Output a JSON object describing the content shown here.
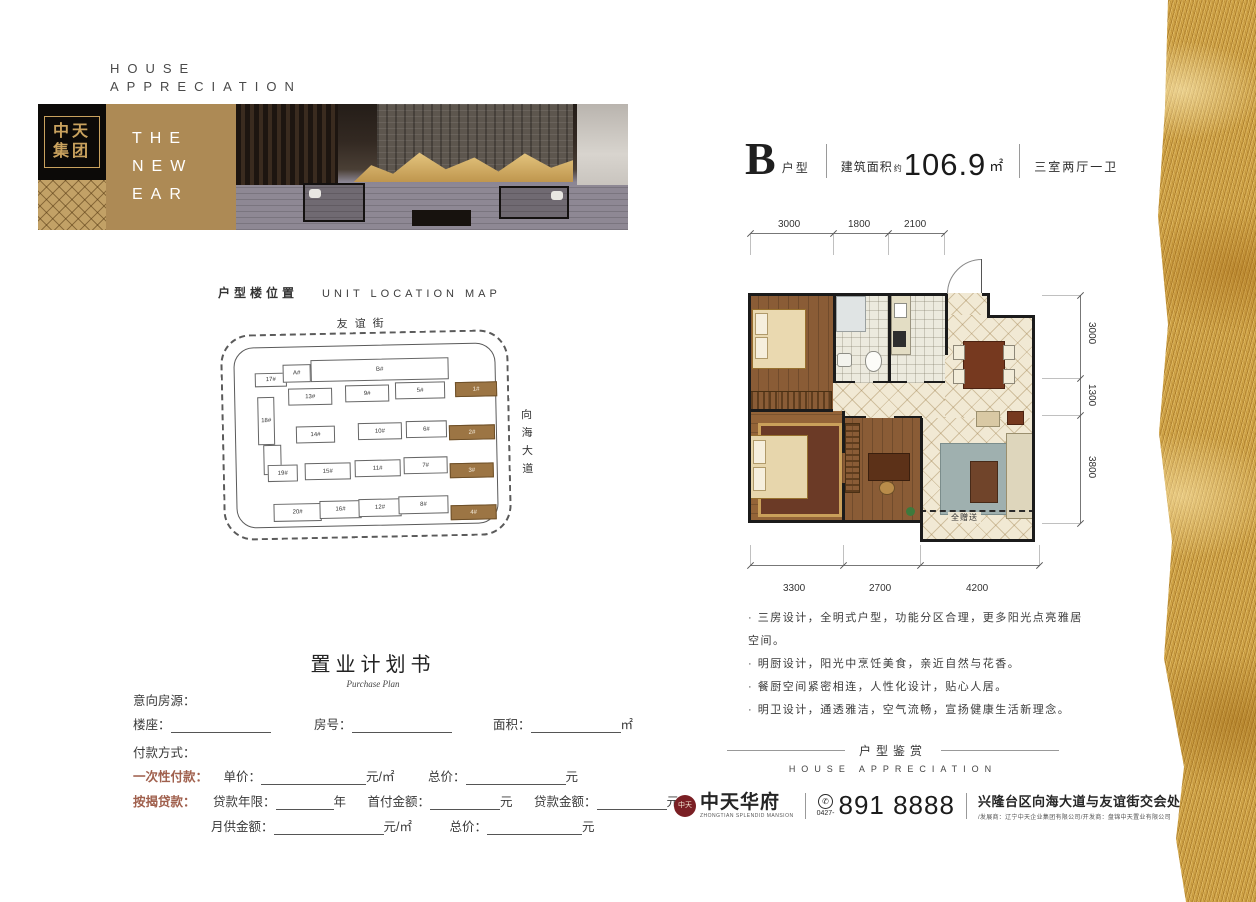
{
  "colors": {
    "accent_gold": "#ad8a55",
    "highlight_brown": "#9c7544",
    "form_red": "#a0604d",
    "seal_red": "#7a1f24"
  },
  "header_small": {
    "line1": "HOUSE",
    "line2": "APPRECIATION"
  },
  "banner": {
    "logo_line1": "中天",
    "logo_line2": "集团",
    "tagline1": "THE",
    "tagline2": "NEW",
    "tagline3": "EAR"
  },
  "location_map": {
    "title_cn": "户型楼位置",
    "title_en": "UNIT LOCATION MAP",
    "street_top": "友谊街",
    "street_right": "向海大道",
    "buildings": [
      {
        "label": "17#",
        "x": 18,
        "y": 25,
        "w": 30,
        "h": 12
      },
      {
        "label": "A#",
        "x": 46,
        "y": 17,
        "w": 26,
        "h": 16
      },
      {
        "label": "B#",
        "x": 74,
        "y": 13,
        "w": 136,
        "h": 20
      },
      {
        "label": "1#",
        "x": 218,
        "y": 38,
        "w": 40,
        "h": 13,
        "hl": true
      },
      {
        "label": "13#",
        "x": 51,
        "y": 41,
        "w": 42,
        "h": 15
      },
      {
        "label": "9#",
        "x": 108,
        "y": 39,
        "w": 42,
        "h": 15
      },
      {
        "label": "5#",
        "x": 158,
        "y": 37,
        "w": 48,
        "h": 15
      },
      {
        "label": "18#",
        "x": 20,
        "y": 49,
        "w": 15,
        "h": 46
      },
      {
        "label": "14#",
        "x": 58,
        "y": 79,
        "w": 37,
        "h": 15
      },
      {
        "label": "10#",
        "x": 120,
        "y": 77,
        "w": 42,
        "h": 15
      },
      {
        "label": "6#",
        "x": 168,
        "y": 76,
        "w": 39,
        "h": 15
      },
      {
        "label": "2#",
        "x": 211,
        "y": 81,
        "w": 44,
        "h": 13,
        "hl": true
      },
      {
        "label": "",
        "x": 25,
        "y": 97,
        "w": 16,
        "h": 28
      },
      {
        "label": "19#",
        "x": 29,
        "y": 117,
        "w": 28,
        "h": 15
      },
      {
        "label": "15#",
        "x": 66,
        "y": 116,
        "w": 44,
        "h": 15
      },
      {
        "label": "11#",
        "x": 116,
        "y": 114,
        "w": 44,
        "h": 15
      },
      {
        "label": "7#",
        "x": 165,
        "y": 112,
        "w": 42,
        "h": 15
      },
      {
        "label": "3#",
        "x": 211,
        "y": 119,
        "w": 42,
        "h": 13,
        "hl": true
      },
      {
        "label": "20#",
        "x": 34,
        "y": 156,
        "w": 46,
        "h": 16
      },
      {
        "label": "16#",
        "x": 80,
        "y": 154,
        "w": 40,
        "h": 16
      },
      {
        "label": "12#",
        "x": 119,
        "y": 153,
        "w": 41,
        "h": 16
      },
      {
        "label": "8#",
        "x": 159,
        "y": 151,
        "w": 48,
        "h": 16
      },
      {
        "label": "4#",
        "x": 211,
        "y": 161,
        "w": 44,
        "h": 13,
        "hl": true
      }
    ]
  },
  "unit": {
    "letter": "B",
    "type_label": "户型",
    "area_label": "建筑面积",
    "approx": "约",
    "area_value": "106.9",
    "area_unit": "㎡",
    "rooms": "三室两厅一卫",
    "dims_top": [
      "3000",
      "1800",
      "2100"
    ],
    "dims_bottom": [
      "3300",
      "2700",
      "4200"
    ],
    "dims_right": [
      "3000",
      "1300",
      "3800"
    ],
    "gift_label": "全赠送",
    "bullets": [
      "三房设计，全明式户型，功能分区合理，更多阳光点亮雅居空间。",
      "明厨设计，阳光中烹饪美食，亲近自然与花香。",
      "餐厨空间紧密相连，人性化设计，贴心人居。",
      "明卫设计，通透雅洁，空气流畅，宣扬健康生活新理念。"
    ]
  },
  "form": {
    "title": "置业计划书",
    "subtitle": "Purchase Plan",
    "intent_label": "意向房源：",
    "building_label": "楼座：",
    "room_label": "房号：",
    "area_label": "面积：",
    "area_unit": "㎡",
    "payment_label": "付款方式：",
    "lump_label": "一次性付款：",
    "unit_price_label": "单价：",
    "per_unit": "元/㎡",
    "total_label": "总价：",
    "yuan": "元",
    "mortgage_label": "按揭贷款：",
    "years_label": "贷款年限：",
    "years_unit": "年",
    "down_label": "首付金额：",
    "loan_label": "贷款金额：",
    "monthly_label": "月供金额："
  },
  "apprec": {
    "cn": "户型鉴赏",
    "en": "HOUSE APPRECIATION"
  },
  "footer": {
    "brand_seal": "中天",
    "brand": "中天华府",
    "brand_sub": "ZHONGTIAN SPLENDID MANSION",
    "phone_glyph": "✆",
    "phone_code": "0427-",
    "phone": "891 8888",
    "address": "兴隆台区向海大道与友谊街交会处",
    "developers": "/发展商：辽宁中天企业集团有限公司/开发商：盘锦中天置业有限公司"
  }
}
